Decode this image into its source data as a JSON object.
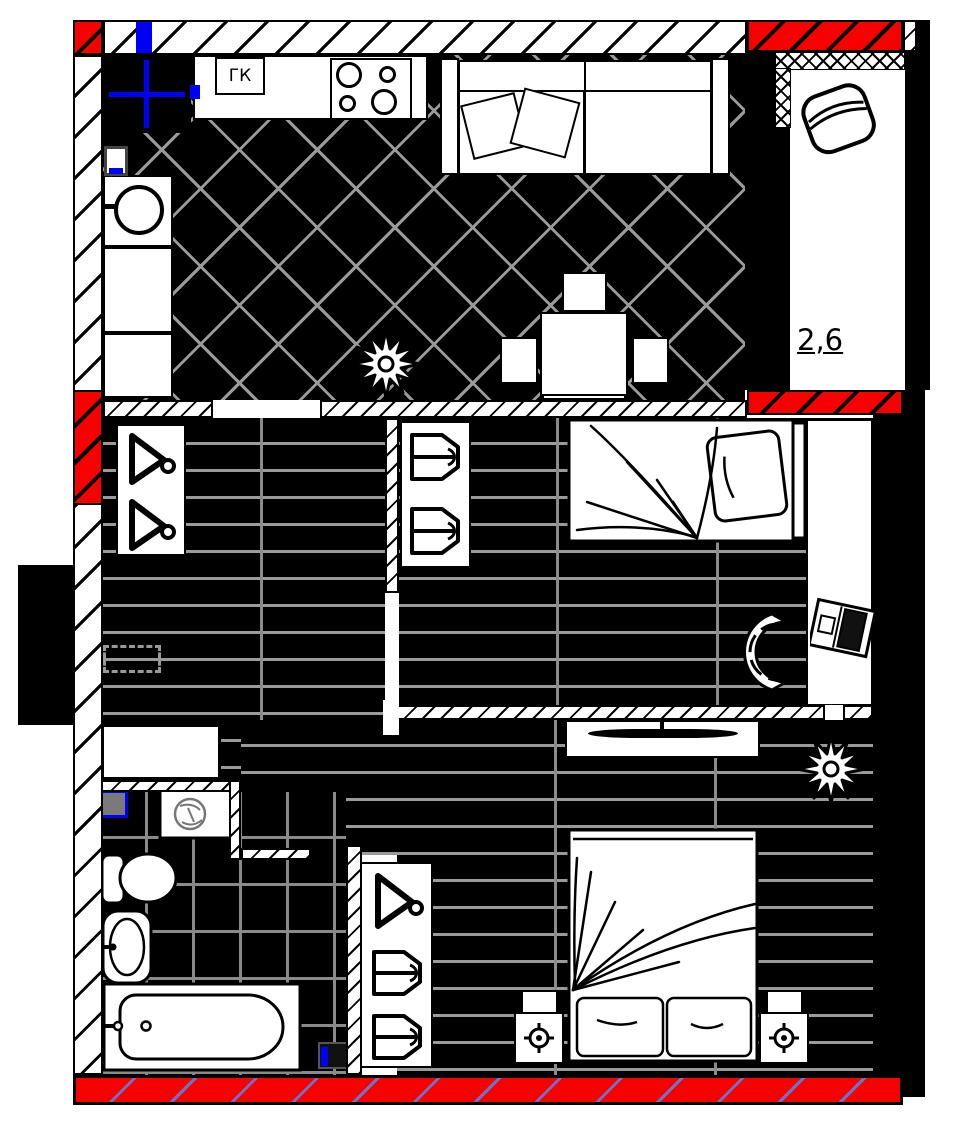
{
  "plan": {
    "title": "apartment-floor-plan",
    "labels": {
      "gas_boiler": "ГК",
      "balcony_area": "2,6"
    },
    "colors": {
      "wall_red": "#f70000",
      "accent_blue": "#0000f6",
      "floor_black": "#000000",
      "tile_line": "#9a9a9a",
      "band_line": "#6b74c8",
      "vent_gray": "#7a7a7a"
    },
    "rooms": [
      {
        "name": "kitchen-living-room",
        "floor": "dark-diagonal-tile",
        "furniture": [
          "vent-shaft",
          "gas-boiler-box",
          "kitchen-counter",
          "stove-4-burners",
          "kitchen-sink",
          "cabinets",
          "sofa-with-pillows",
          "dining-table-with-chairs",
          "plant"
        ]
      },
      {
        "name": "balcony",
        "area_label": "2,6",
        "floor": "white",
        "furniture": [
          "armchair"
        ]
      },
      {
        "name": "hallway",
        "floor": "dark-plank",
        "furniture": [
          "wardrobe-with-hangers",
          "cabinet",
          "dashed-overhead-unit"
        ]
      },
      {
        "name": "bedroom-1",
        "floor": "dark-plank",
        "furniture": [
          "single-bed",
          "shelf-unit",
          "desk",
          "laptop",
          "office-chair"
        ]
      },
      {
        "name": "bedroom-2",
        "floor": "dark-plank",
        "furniture": [
          "double-bed",
          "nightstand-left",
          "nightstand-right",
          "tv-stand",
          "wardrobe-with-hanger",
          "plant"
        ]
      },
      {
        "name": "bathroom",
        "floor": "dark-grid-tile",
        "furniture": [
          "washing-machine",
          "toilet",
          "sink",
          "bathtub",
          "vent-box"
        ]
      }
    ]
  }
}
